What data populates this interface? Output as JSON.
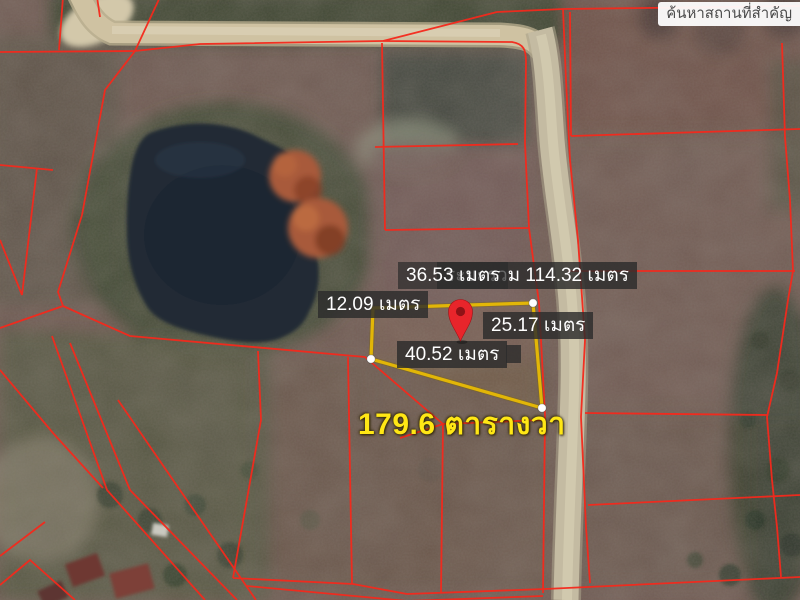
{
  "map": {
    "search_box": {
      "label": "ค้นหาสถานที่สำคัญ"
    },
    "parcel": {
      "area_label": "179.6 ตารางวา",
      "measurements": {
        "top_edge": "36.53 เมตร",
        "perimeter_total": "ระยะรวม 114.32 เมตร",
        "left_edge": "12.09 เมตร",
        "right_edge": "25.17 เมตร",
        "bottom_edge": "40.52 เมตร"
      }
    },
    "colors": {
      "parcel_boundary_red": "#f5291c",
      "selection_outline_yellow": "#e2b607",
      "area_text_yellow": "#ffe715",
      "pin_red": "#e8252b",
      "label_background": "rgba(44,44,44,0.82)",
      "label_text": "#ffffff"
    },
    "icons": {
      "pin": "location-pin-icon",
      "vertex": "vertex-handle"
    }
  }
}
